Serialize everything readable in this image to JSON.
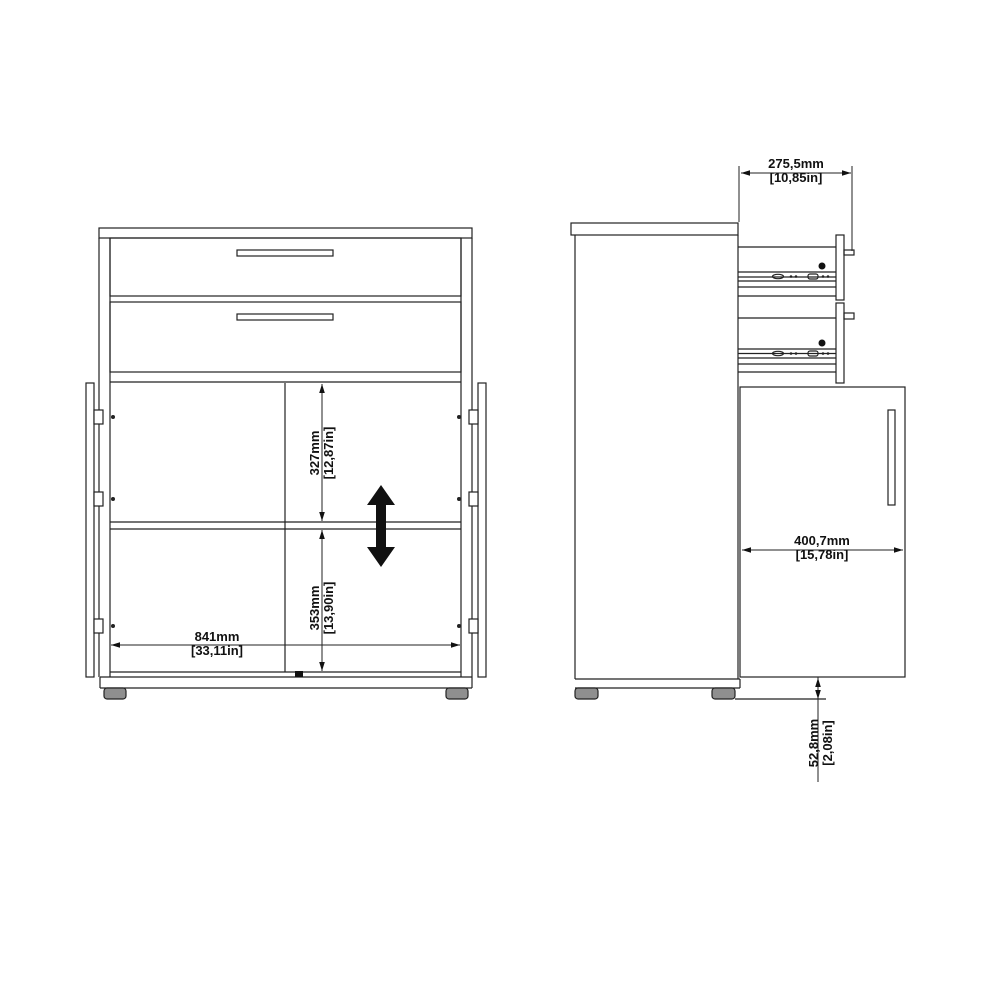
{
  "drawing": {
    "type": "furniture-technical-drawing",
    "views": [
      "front-view",
      "side-view"
    ],
    "dimensions": {
      "depth": {
        "mm": "275,5mm",
        "inches": "[10,85in]"
      },
      "upper_compartment_height": {
        "mm": "327mm",
        "inches": "[12,87in]"
      },
      "lower_compartment_height": {
        "mm": "353mm",
        "inches": "[13,90in]"
      },
      "interior_width": {
        "mm": "841mm",
        "inches": "[33,11in]"
      },
      "door_width": {
        "mm": "400,7mm",
        "inches": "[15,78in]"
      },
      "foot_height": {
        "mm": "52,8mm",
        "inches": "[2,08in]"
      }
    },
    "icons": {
      "adjustable_shelf_arrow": "double-vertical-arrow"
    },
    "colors": {
      "line": "#222222",
      "background": "#ffffff",
      "foot_fill": "#8f8f8f",
      "arrow_fill": "#111111"
    }
  }
}
